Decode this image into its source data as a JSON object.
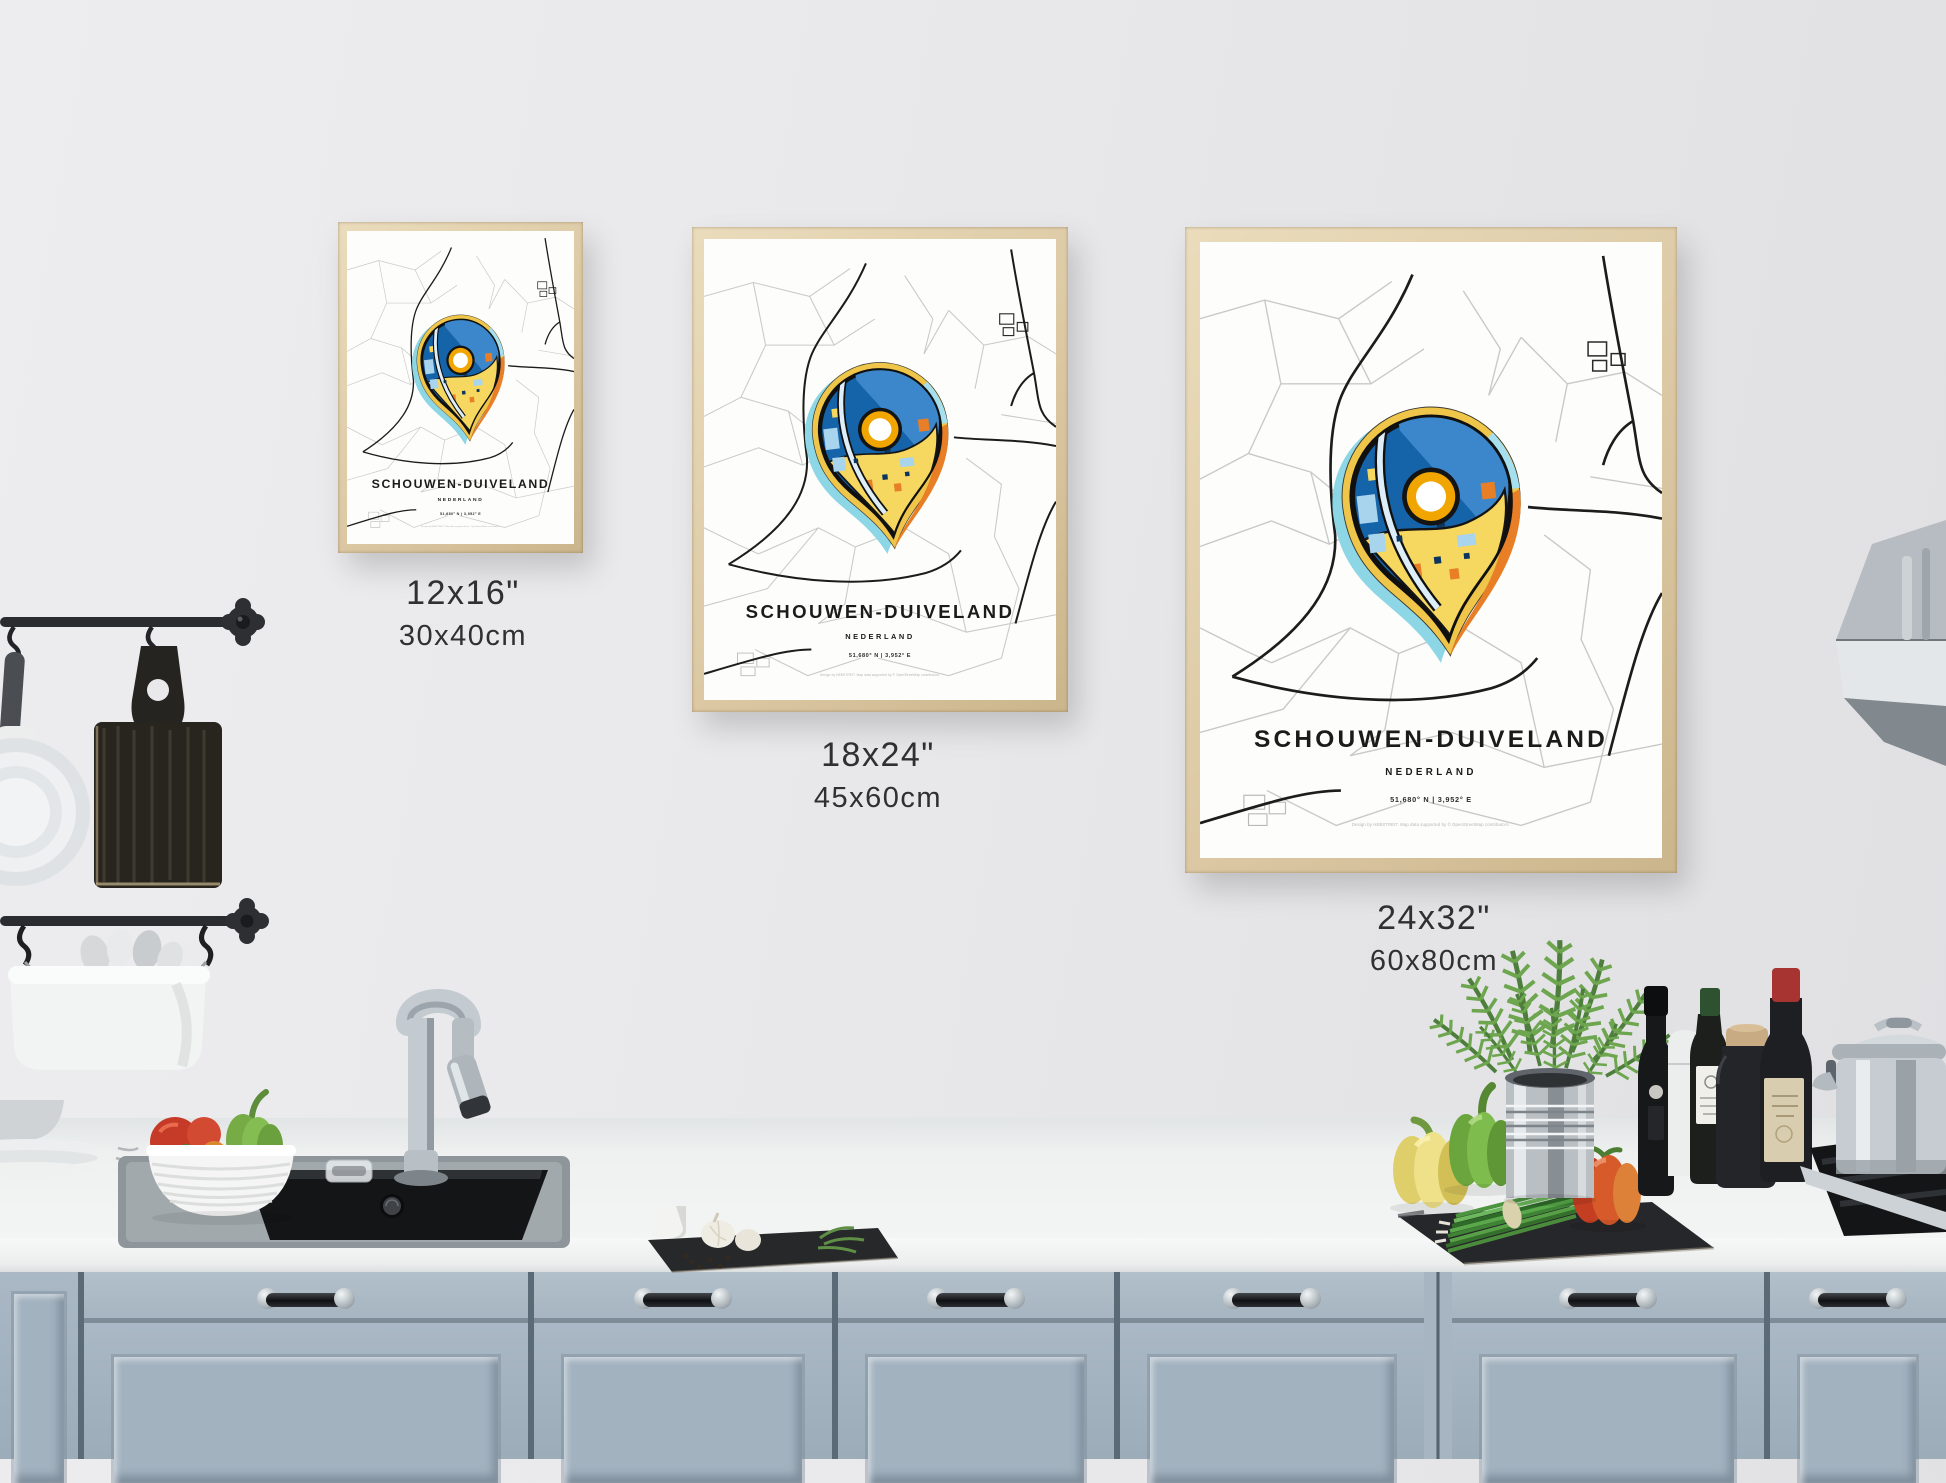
{
  "poster": {
    "title": "SCHOUWEN-DUIVELAND",
    "subtitle": "NEDERLAND",
    "coordinates": "51,680° N | 3,952° E",
    "credit": "Design by HEBSTREIT. Map data supported by © OpenStreetMap contributors."
  },
  "size_labels": [
    {
      "inches": "12x16\"",
      "cm": "30x40cm"
    },
    {
      "inches": "18x24\"",
      "cm": "45x60cm"
    },
    {
      "inches": "24x32\"",
      "cm": "60x80cm"
    }
  ],
  "colors": {
    "frame_wood": "#dcc9a4",
    "map_road_minor": "#c9c9c9",
    "map_road_major": "#1c1c1c",
    "pin_blue": "#1563a8",
    "pin_blue_light": "#3c87cc",
    "pin_yellow": "#f6d75f",
    "pin_orange": "#e87f26",
    "pin_cyan": "#8cd6e6",
    "pin_ring_yellow": "#f0c64a",
    "donut_yellow": "#f0a500",
    "cabinet_blue_gray": "#a5b4c0"
  }
}
